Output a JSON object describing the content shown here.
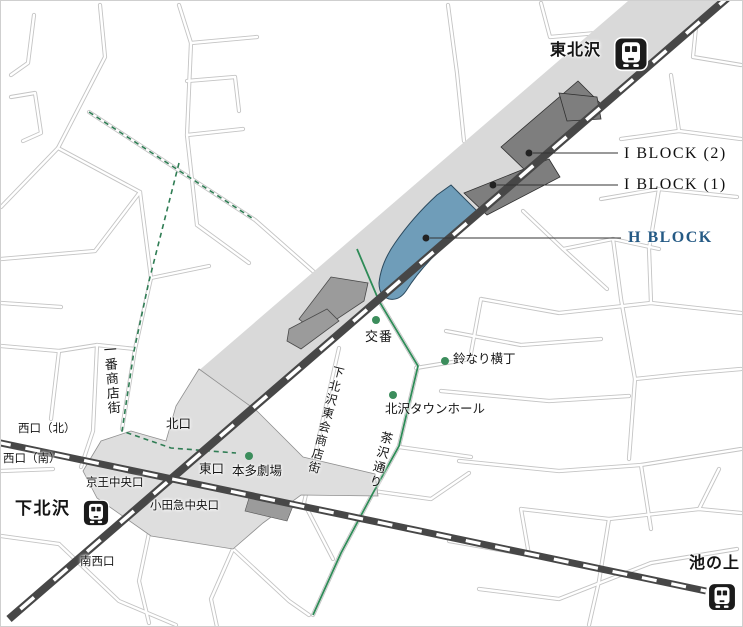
{
  "stations": {
    "tohokuzawa": "東北沢",
    "shimokitazawa": "下北沢",
    "ikenoue": "池の上"
  },
  "blocks": {
    "i_block_2": "I BLOCK (2)",
    "i_block_1": "I BLOCK (1)",
    "h_block": "H BLOCK"
  },
  "landmarks": {
    "koban": "交番",
    "suzunari_yokocho": "鈴なり横丁",
    "kitazawa_town_hall": "北沢タウンホール",
    "honda_gekijo": "本多劇場"
  },
  "streets": {
    "ichiban_shotengai": "一番商店街",
    "higashikai_shotengai": "下北沢東会商店街",
    "chazawa_dori": "茶沢通り"
  },
  "exits": {
    "west_north": "西口（北）",
    "west_south": "西口（南）",
    "north": "北口",
    "east": "東口",
    "keio_central": "京王中央口",
    "odakyu_central": "小田急中央口",
    "southwest": "南西口"
  },
  "icons": {
    "station_icon": "train-icon"
  },
  "colors": {
    "h_block_fill": "#6F9DB9",
    "h_block_label": "#255A85",
    "i_block_fill": "#7E7E7E",
    "mid_block_fill": "#9B9B9B",
    "corridor_fill": "#D9D9D9",
    "plaza_fill": "#DEDEDE",
    "railway": "#474747",
    "landmark_dot": "#3C8D5C",
    "route_green": "#2E8B57",
    "street_line": "#C4C4C4"
  }
}
